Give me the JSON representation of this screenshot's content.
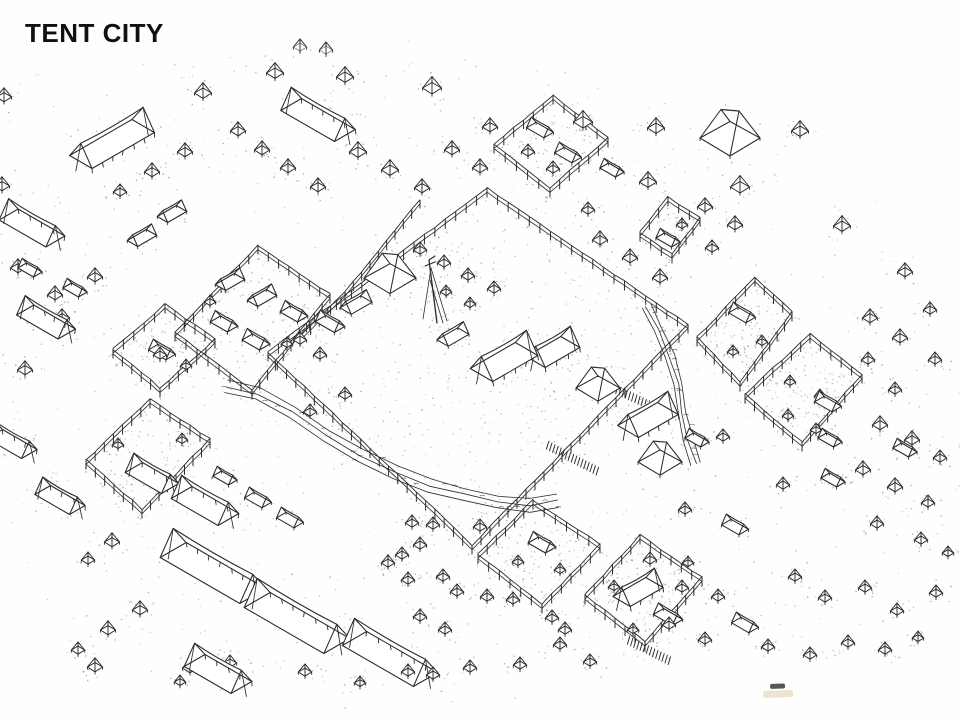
{
  "slide": {
    "title": "TENT CITY"
  },
  "colors": {
    "ink": "#2b2b2b",
    "paper": "#fefefe",
    "stipple": "#5f5f5f",
    "ghost": "#909090",
    "smudge_dark": "#3a3a3a",
    "smudge_tan": "#d9c9a0"
  },
  "drawing": {
    "width": 960,
    "height": 720,
    "stipple_seed": 42,
    "ambient_dots": 620,
    "occupancy": [
      [
        0,
        70
      ],
      [
        180,
        45
      ],
      [
        330,
        30
      ],
      [
        520,
        55
      ],
      [
        660,
        90
      ],
      [
        700,
        105
      ],
      [
        780,
        140
      ],
      [
        880,
        200
      ],
      [
        960,
        270
      ],
      [
        960,
        560
      ],
      [
        905,
        610
      ],
      [
        830,
        660
      ],
      [
        740,
        660
      ],
      [
        640,
        690
      ],
      [
        520,
        700
      ],
      [
        380,
        695
      ],
      [
        260,
        690
      ],
      [
        150,
        680
      ],
      [
        60,
        640
      ],
      [
        0,
        560
      ]
    ],
    "mast": {
      "x": 437,
      "top": 260,
      "base": 323
    },
    "smudges": [
      {
        "x": 770,
        "y": 684,
        "w": 15,
        "h": 5,
        "color": "dark"
      },
      {
        "x": 763,
        "y": 691,
        "w": 30,
        "h": 7,
        "color": "tan"
      }
    ],
    "streams": [
      {
        "path": [
          [
            226,
            386
          ],
          [
            258,
            394
          ],
          [
            292,
            412
          ],
          [
            326,
            436
          ],
          [
            360,
            456
          ],
          [
            396,
            472
          ],
          [
            430,
            486
          ],
          [
            464,
            495
          ],
          [
            498,
            502
          ],
          [
            530,
            505
          ],
          [
            558,
            501
          ]
        ],
        "width": 13
      },
      {
        "path": [
          [
            646,
            306
          ],
          [
            658,
            330
          ],
          [
            670,
            356
          ],
          [
            678,
            384
          ],
          [
            682,
            412
          ],
          [
            688,
            440
          ],
          [
            696,
            464
          ]
        ],
        "width": 9
      }
    ],
    "zigzags": [
      [
        613,
        388,
        664,
        412
      ],
      [
        547,
        445,
        597,
        471
      ],
      [
        628,
        640,
        668,
        660
      ]
    ],
    "fences": [
      {
        "pts": [
          [
            487,
            196
          ],
          [
            688,
            332
          ],
          [
            472,
            553
          ],
          [
            268,
            360
          ]
        ],
        "closed": true,
        "fill_dots": 300
      },
      {
        "pts": [
          [
            420,
            207
          ],
          [
            345,
            300
          ],
          [
            302,
            342
          ]
        ],
        "closed": false,
        "fill_dots": 0
      },
      {
        "pts": [
          [
            258,
            253
          ],
          [
            330,
            302
          ],
          [
            252,
            398
          ],
          [
            175,
            340
          ]
        ],
        "closed": true,
        "fill_dots": 90
      },
      {
        "pts": [
          [
            165,
            312
          ],
          [
            215,
            347
          ],
          [
            160,
            396
          ],
          [
            113,
            357
          ]
        ],
        "closed": true,
        "fill_dots": 55
      },
      {
        "pts": [
          [
            150,
            407
          ],
          [
            210,
            447
          ],
          [
            142,
            517
          ],
          [
            86,
            468
          ]
        ],
        "closed": true,
        "fill_dots": 70
      },
      {
        "pts": [
          [
            553,
            103
          ],
          [
            608,
            146
          ],
          [
            550,
            196
          ],
          [
            494,
            152
          ]
        ],
        "closed": true,
        "fill_dots": 55
      },
      {
        "pts": [
          [
            668,
            205
          ],
          [
            700,
            225
          ],
          [
            672,
            262
          ],
          [
            640,
            240
          ]
        ],
        "closed": true,
        "fill_dots": 35
      },
      {
        "pts": [
          [
            755,
            285
          ],
          [
            792,
            320
          ],
          [
            740,
            390
          ],
          [
            697,
            345
          ]
        ],
        "closed": true,
        "fill_dots": 85
      },
      {
        "pts": [
          [
            810,
            342
          ],
          [
            862,
            382
          ],
          [
            802,
            450
          ],
          [
            745,
            402
          ]
        ],
        "closed": true,
        "fill_dots": 95
      },
      {
        "pts": [
          [
            533,
            508
          ],
          [
            600,
            552
          ],
          [
            542,
            612
          ],
          [
            478,
            562
          ]
        ],
        "closed": true,
        "fill_dots": 85
      },
      {
        "pts": [
          [
            640,
            543
          ],
          [
            702,
            585
          ],
          [
            645,
            650
          ],
          [
            585,
            603
          ]
        ],
        "closed": true,
        "fill_dots": 110
      }
    ],
    "tents": {
      "small": [
        [
          116,
          143,
          8
        ],
        [
          203,
          93,
          9
        ],
        [
          275,
          73,
          9
        ],
        [
          345,
          77,
          9
        ],
        [
          432,
          88,
          10
        ],
        [
          490,
          127,
          8
        ],
        [
          583,
          122,
          10
        ],
        [
          656,
          128,
          9
        ],
        [
          648,
          182,
          9
        ],
        [
          740,
          187,
          10
        ],
        [
          800,
          131,
          9
        ],
        [
          842,
          226,
          9
        ],
        [
          905,
          272,
          8
        ],
        [
          4,
          97,
          8
        ],
        [
          2,
          186,
          8
        ],
        [
          18,
          268,
          8
        ],
        [
          55,
          295,
          8
        ],
        [
          95,
          277,
          8
        ],
        [
          120,
          192,
          7
        ],
        [
          152,
          172,
          8
        ],
        [
          185,
          152,
          8
        ],
        [
          238,
          131,
          8
        ],
        [
          262,
          150,
          8
        ],
        [
          288,
          168,
          8
        ],
        [
          318,
          187,
          8
        ],
        [
          358,
          152,
          9
        ],
        [
          390,
          170,
          9
        ],
        [
          422,
          188,
          8
        ],
        [
          452,
          150,
          8
        ],
        [
          480,
          168,
          8
        ],
        [
          528,
          152,
          7
        ],
        [
          553,
          169,
          7
        ],
        [
          588,
          210,
          7
        ],
        [
          600,
          240,
          8
        ],
        [
          630,
          258,
          8
        ],
        [
          660,
          278,
          8
        ],
        [
          705,
          207,
          8
        ],
        [
          735,
          225,
          8
        ],
        [
          712,
          248,
          7
        ],
        [
          682,
          225,
          6
        ],
        [
          870,
          318,
          8
        ],
        [
          900,
          338,
          8
        ],
        [
          930,
          310,
          7
        ],
        [
          935,
          360,
          7
        ],
        [
          868,
          360,
          7
        ],
        [
          895,
          390,
          7
        ],
        [
          880,
          425,
          8
        ],
        [
          912,
          440,
          8
        ],
        [
          940,
          458,
          7
        ],
        [
          863,
          470,
          8
        ],
        [
          895,
          487,
          8
        ],
        [
          928,
          503,
          7
        ],
        [
          420,
          250,
          7
        ],
        [
          444,
          263,
          7
        ],
        [
          468,
          276,
          7
        ],
        [
          494,
          289,
          7
        ],
        [
          446,
          292,
          6
        ],
        [
          470,
          304,
          6
        ],
        [
          320,
          355,
          7
        ],
        [
          300,
          340,
          7
        ],
        [
          345,
          395,
          7
        ],
        [
          310,
          412,
          7
        ],
        [
          62,
          318,
          8
        ],
        [
          25,
          370,
          8
        ],
        [
          160,
          355,
          7
        ],
        [
          186,
          366,
          6
        ],
        [
          118,
          445,
          6
        ],
        [
          182,
          440,
          6
        ],
        [
          210,
          302,
          6
        ],
        [
          287,
          344,
          6
        ],
        [
          112,
          542,
          8
        ],
        [
          88,
          560,
          7
        ],
        [
          140,
          610,
          8
        ],
        [
          108,
          630,
          8
        ],
        [
          78,
          650,
          7
        ],
        [
          95,
          667,
          8
        ],
        [
          190,
          668,
          8
        ],
        [
          230,
          663,
          7
        ],
        [
          412,
          523,
          7
        ],
        [
          433,
          525,
          7
        ],
        [
          480,
          527,
          7
        ],
        [
          420,
          545,
          7
        ],
        [
          402,
          555,
          7
        ],
        [
          388,
          563,
          7
        ],
        [
          408,
          580,
          7
        ],
        [
          443,
          577,
          7
        ],
        [
          457,
          592,
          7
        ],
        [
          420,
          617,
          7
        ],
        [
          445,
          630,
          7
        ],
        [
          487,
          597,
          7
        ],
        [
          513,
          600,
          7
        ],
        [
          552,
          618,
          7
        ],
        [
          565,
          630,
          7
        ],
        [
          633,
          630,
          6
        ],
        [
          433,
          675,
          7
        ],
        [
          408,
          672,
          7
        ],
        [
          305,
          672,
          7
        ],
        [
          360,
          683,
          6
        ],
        [
          180,
          682,
          6
        ],
        [
          470,
          668,
          7
        ],
        [
          520,
          665,
          7
        ],
        [
          560,
          645,
          7
        ],
        [
          590,
          662,
          7
        ],
        [
          723,
          437,
          7
        ],
        [
          685,
          510,
          7
        ],
        [
          783,
          485,
          7
        ],
        [
          877,
          524,
          7
        ],
        [
          921,
          540,
          7
        ],
        [
          948,
          553,
          6
        ],
        [
          650,
          560,
          7
        ],
        [
          682,
          588,
          7
        ],
        [
          718,
          597,
          7
        ],
        [
          795,
          577,
          7
        ],
        [
          825,
          598,
          7
        ],
        [
          865,
          588,
          7
        ],
        [
          897,
          611,
          7
        ],
        [
          936,
          593,
          7
        ],
        [
          669,
          625,
          7
        ],
        [
          705,
          640,
          7
        ],
        [
          768,
          647,
          7
        ],
        [
          810,
          655,
          7
        ],
        [
          848,
          643,
          7
        ],
        [
          885,
          650,
          7
        ],
        [
          918,
          638,
          6
        ],
        [
          762,
          342,
          6
        ],
        [
          733,
          352,
          6
        ],
        [
          790,
          382,
          6
        ],
        [
          820,
          396,
          6
        ],
        [
          788,
          416,
          6
        ],
        [
          816,
          430,
          6
        ],
        [
          560,
          570,
          6
        ],
        [
          518,
          562,
          6
        ],
        [
          614,
          587,
          6
        ],
        [
          688,
          563,
          6
        ]
      ],
      "small_gray": [
        [
          300,
          47,
          7
        ],
        [
          326,
          50,
          7
        ]
      ],
      "ridge": [
        [
          172,
          214,
          22,
          12,
          1
        ],
        [
          142,
          238,
          22,
          12,
          1
        ],
        [
          540,
          130,
          20,
          11,
          -1
        ],
        [
          568,
          155,
          20,
          11,
          -1
        ],
        [
          668,
          240,
          18,
          10,
          -1
        ],
        [
          612,
          170,
          18,
          10,
          -1
        ],
        [
          230,
          282,
          22,
          12,
          1
        ],
        [
          262,
          298,
          22,
          12,
          1
        ],
        [
          294,
          314,
          20,
          12,
          -1
        ],
        [
          224,
          324,
          20,
          12,
          -1
        ],
        [
          256,
          342,
          20,
          12,
          -1
        ],
        [
          356,
          305,
          24,
          13,
          1
        ],
        [
          330,
          324,
          22,
          12,
          -1
        ],
        [
          453,
          337,
          24,
          13,
          1
        ],
        [
          162,
          352,
          20,
          11,
          -1
        ],
        [
          30,
          270,
          18,
          10,
          -1
        ],
        [
          75,
          290,
          18,
          10,
          -1
        ],
        [
          258,
          500,
          20,
          11,
          -1
        ],
        [
          290,
          520,
          20,
          11,
          -1
        ],
        [
          225,
          478,
          18,
          10,
          -1
        ],
        [
          542,
          545,
          20,
          12,
          -1
        ],
        [
          668,
          617,
          22,
          12,
          -1
        ],
        [
          742,
          315,
          20,
          11,
          -1
        ],
        [
          828,
          404,
          20,
          11,
          -1
        ],
        [
          697,
          440,
          18,
          10,
          -1
        ],
        [
          830,
          440,
          18,
          10,
          -1
        ],
        [
          905,
          450,
          18,
          10,
          -1
        ],
        [
          735,
          527,
          20,
          11,
          -1
        ],
        [
          745,
          625,
          20,
          11,
          -1
        ],
        [
          833,
          480,
          18,
          10,
          -1
        ]
      ],
      "marquee": [
        [
          112,
          144,
          72,
          26,
          1
        ],
        [
          318,
          120,
          62,
          24,
          -1
        ],
        [
          32,
          228,
          54,
          22,
          -1
        ],
        [
          46,
          322,
          48,
          20,
          -1
        ],
        [
          12,
          444,
          40,
          18,
          -1
        ],
        [
          60,
          500,
          40,
          18,
          -1
        ],
        [
          205,
          506,
          54,
          24,
          -1
        ],
        [
          213,
          573,
          92,
          30,
          -1
        ],
        [
          297,
          623,
          92,
          30,
          -1
        ],
        [
          390,
          659,
          82,
          28,
          -1
        ],
        [
          218,
          674,
          54,
          24,
          -1
        ],
        [
          152,
          478,
          42,
          20,
          -1
        ],
        [
          504,
          362,
          52,
          26,
          1
        ],
        [
          553,
          352,
          40,
          22,
          1
        ],
        [
          648,
          420,
          46,
          24,
          1
        ],
        [
          638,
          592,
          38,
          20,
          1
        ]
      ],
      "pavilion": [
        [
          390,
          278,
          26
        ],
        [
          730,
          138,
          30
        ],
        [
          598,
          388,
          22
        ],
        [
          660,
          462,
          22
        ]
      ]
    }
  }
}
